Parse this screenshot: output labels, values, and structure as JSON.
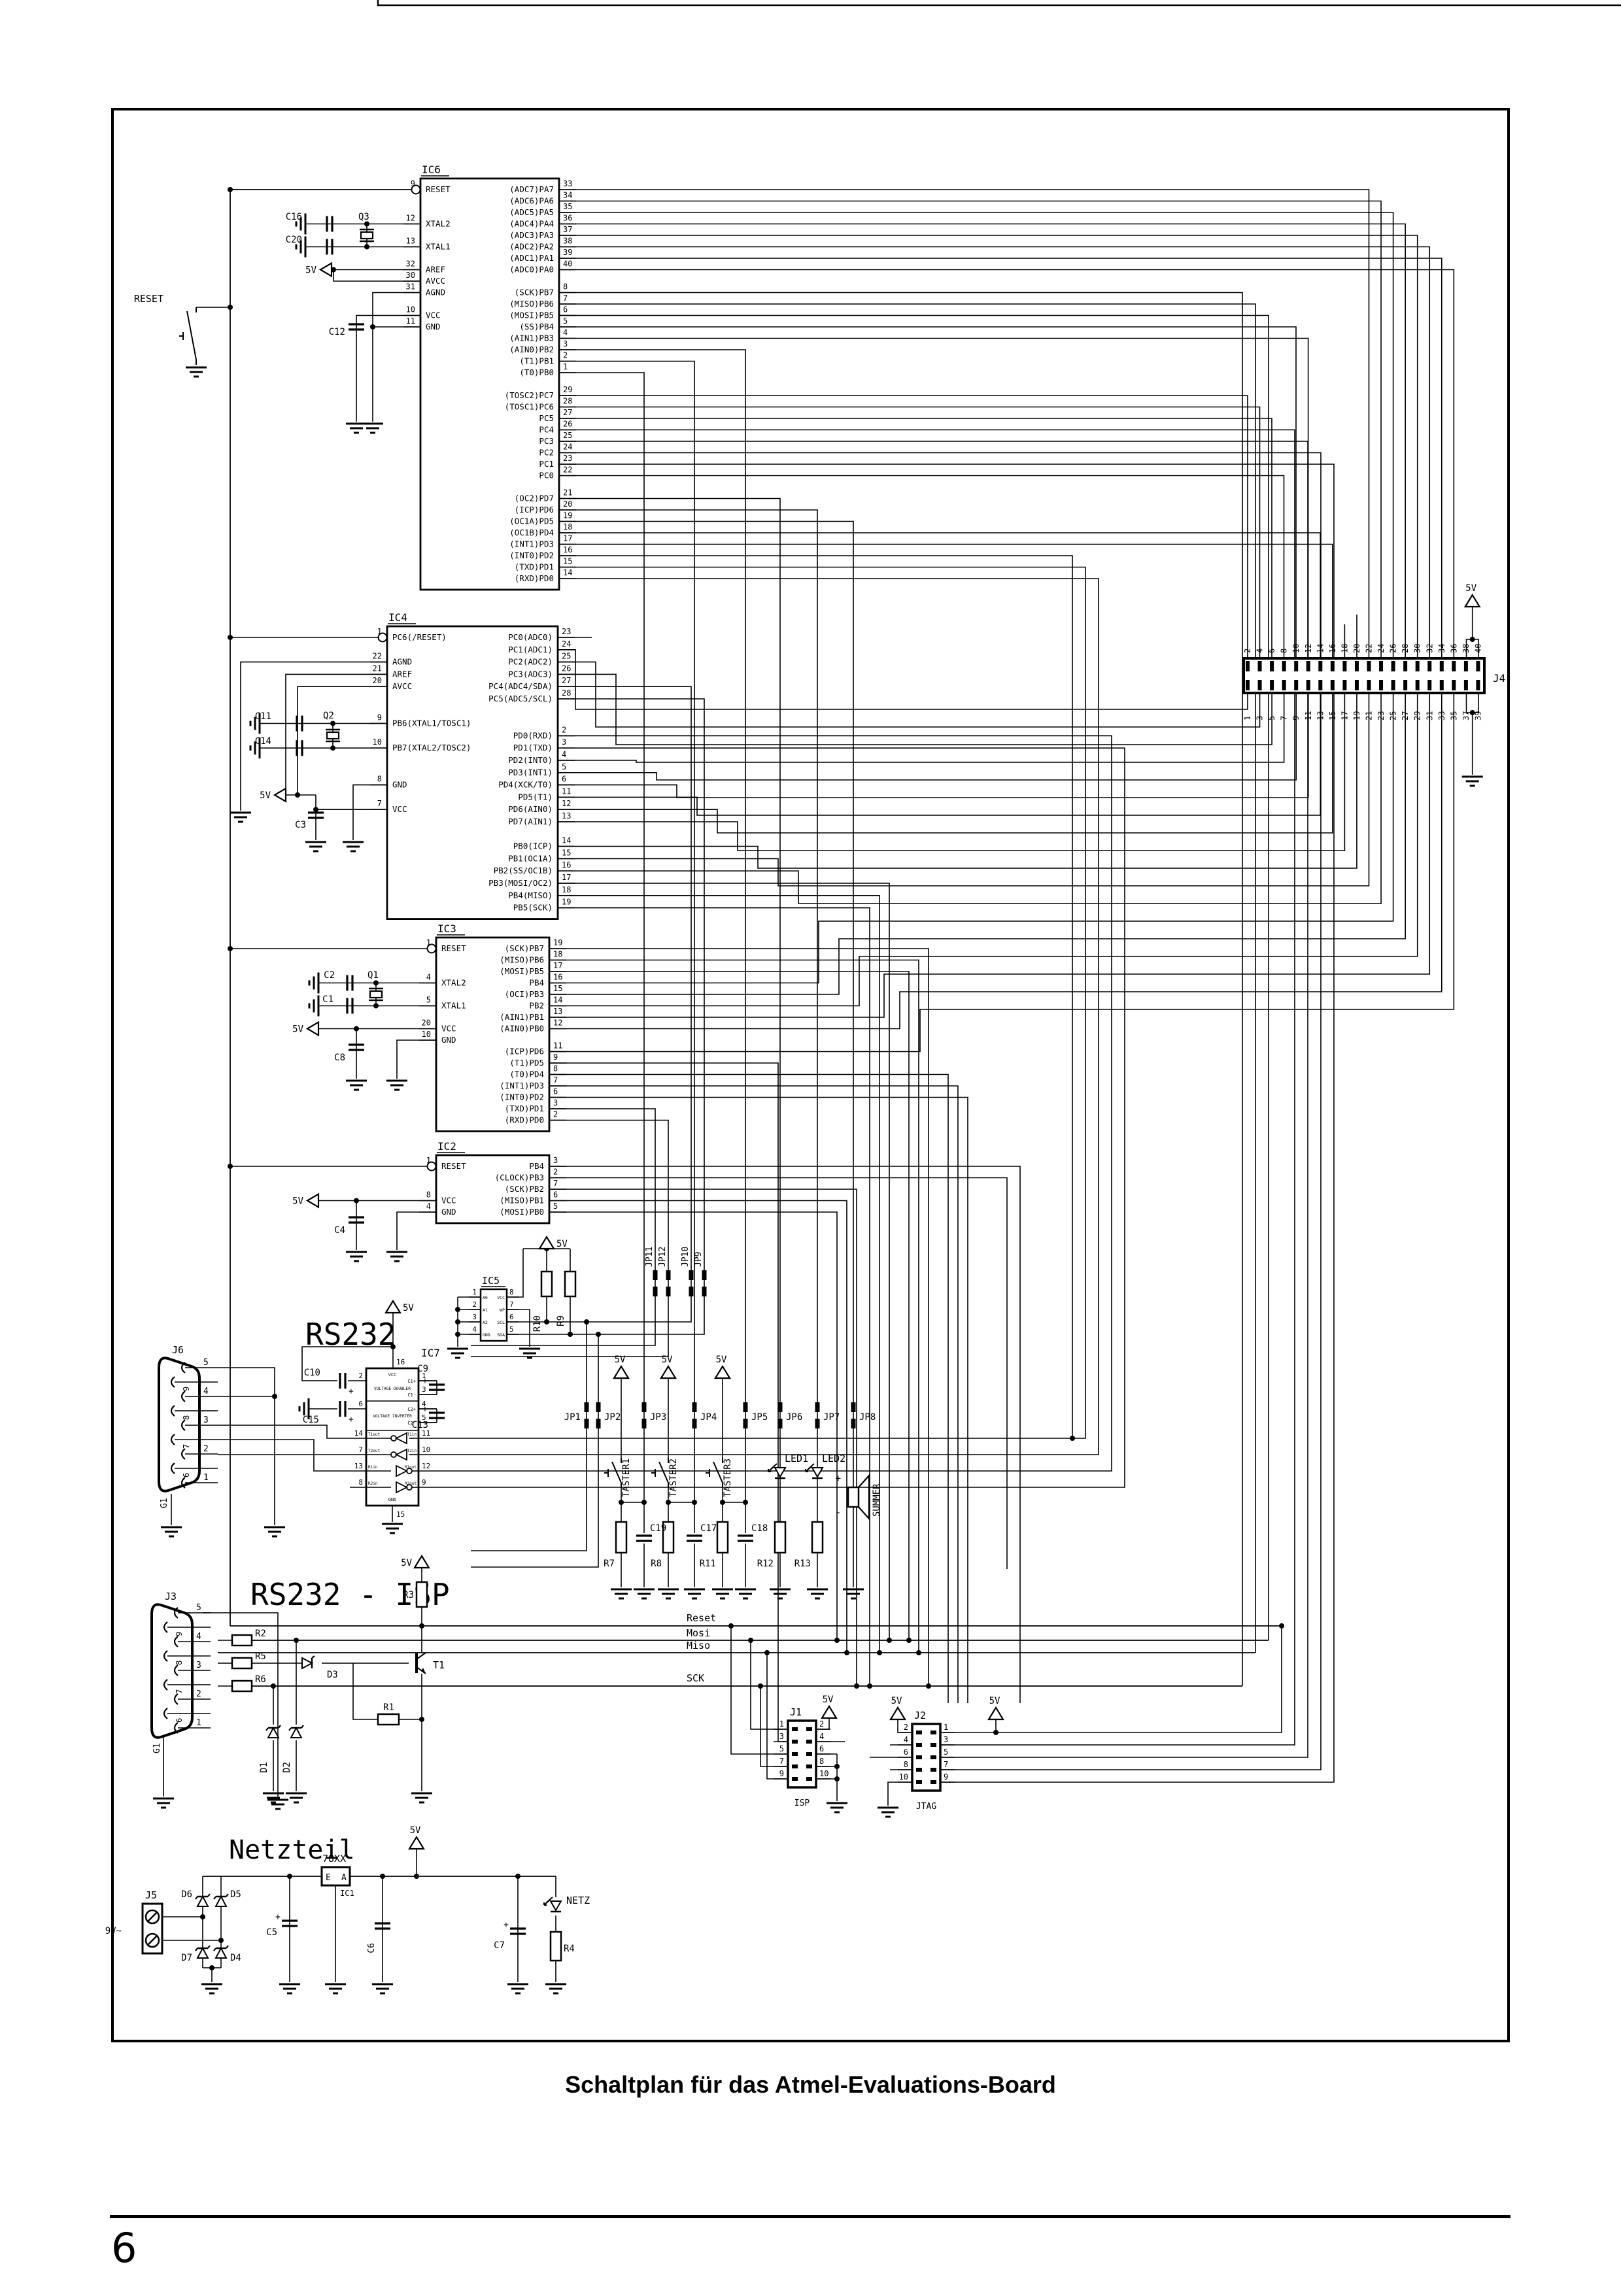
{
  "page": {
    "caption": "Schaltplan für das Atmel-Evaluations-Board",
    "page_number": "6"
  },
  "section_titles": {
    "rs232": "RS232",
    "rs232_isp": "RS232 - ISP",
    "netzteil": "Netzteil"
  },
  "power": {
    "v5": "5V",
    "v9": "9V~"
  },
  "signals": {
    "reset": "Reset",
    "mosi": "Mosi",
    "miso": "Miso",
    "sck": "SCK"
  },
  "ics": {
    "ic6": {
      "title": "IC6",
      "left": [
        [
          "9",
          "RESET",
          1
        ],
        null,
        null,
        [
          "12",
          "XTAL2"
        ],
        null,
        [
          "13",
          "XTAL1"
        ],
        null,
        [
          "32",
          "AREF"
        ],
        [
          "30",
          "AVCC"
        ],
        [
          "31",
          "AGND"
        ],
        null,
        [
          "10",
          "VCC"
        ],
        [
          "11",
          "GND"
        ]
      ],
      "right": [
        [
          "33",
          "(ADC7)PA7"
        ],
        [
          "34",
          "(ADC6)PA6"
        ],
        [
          "35",
          "(ADC5)PA5"
        ],
        [
          "36",
          "(ADC4)PA4"
        ],
        [
          "37",
          "(ADC3)PA3"
        ],
        [
          "38",
          "(ADC2)PA2"
        ],
        [
          "39",
          "(ADC1)PA1"
        ],
        [
          "40",
          "(ADC0)PA0"
        ],
        null,
        [
          "8",
          "(SCK)PB7"
        ],
        [
          "7",
          "(MISO)PB6"
        ],
        [
          "6",
          "(MOSI)PB5"
        ],
        [
          "5",
          "(SS)PB4"
        ],
        [
          "4",
          "(AIN1)PB3"
        ],
        [
          "3",
          "(AIN0)PB2"
        ],
        [
          "2",
          "(T1)PB1"
        ],
        [
          "1",
          "(T0)PB0"
        ],
        null,
        [
          "29",
          "(TOSC2)PC7"
        ],
        [
          "28",
          "(TOSC1)PC6"
        ],
        [
          "27",
          "PC5"
        ],
        [
          "26",
          "PC4"
        ],
        [
          "25",
          "PC3"
        ],
        [
          "24",
          "PC2"
        ],
        [
          "23",
          "PC1"
        ],
        [
          "22",
          "PC0"
        ],
        null,
        [
          "21",
          "(OC2)PD7"
        ],
        [
          "20",
          "(ICP)PD6"
        ],
        [
          "19",
          "(OC1A)PD5"
        ],
        [
          "18",
          "(OC1B)PD4"
        ],
        [
          "17",
          "(INT1)PD3"
        ],
        [
          "16",
          "(INT0)PD2"
        ],
        [
          "15",
          "(TXD)PD1"
        ],
        [
          "14",
          "(RXD)PD0"
        ]
      ]
    },
    "ic4": {
      "title": "IC4",
      "left": [
        [
          "1",
          "PC6(/RESET)",
          1
        ],
        null,
        [
          "22",
          "AGND"
        ],
        [
          "21",
          "AREF"
        ],
        [
          "20",
          "AVCC"
        ],
        null,
        null,
        [
          "9",
          "PB6(XTAL1/TOSC1)"
        ],
        null,
        [
          "10",
          "PB7(XTAL2/TOSC2)"
        ],
        null,
        null,
        [
          "8",
          "GND"
        ],
        null,
        [
          "7",
          "VCC"
        ]
      ],
      "right": [
        [
          "23",
          "PC0(ADC0)"
        ],
        [
          "24",
          "PC1(ADC1)"
        ],
        [
          "25",
          "PC2(ADC2)"
        ],
        [
          "26",
          "PC3(ADC3)"
        ],
        [
          "27",
          "PC4(ADC4/SDA)"
        ],
        [
          "28",
          "PC5(ADC5/SCL)"
        ],
        null,
        null,
        [
          "2",
          "PD0(RXD)"
        ],
        [
          "3",
          "PD1(TXD)"
        ],
        [
          "4",
          "PD2(INT0)"
        ],
        [
          "5",
          "PD3(INT1)"
        ],
        [
          "6",
          "PD4(XCK/T0)"
        ],
        [
          "11",
          "PD5(T1)"
        ],
        [
          "12",
          "PD6(AIN0)"
        ],
        [
          "13",
          "PD7(AIN1)"
        ],
        null,
        [
          "14",
          "PB0(ICP)"
        ],
        [
          "15",
          "PB1(OC1A)"
        ],
        [
          "16",
          "PB2(SS/OC1B)"
        ],
        [
          "17",
          "PB3(MOSI/OC2)"
        ],
        [
          "18",
          "PB4(MISO)"
        ],
        [
          "19",
          "PB5(SCK)"
        ]
      ]
    },
    "ic3": {
      "title": "IC3",
      "left": [
        [
          "1",
          "RESET",
          1
        ],
        null,
        null,
        [
          "4",
          "XTAL2"
        ],
        null,
        [
          "5",
          "XTAL1"
        ],
        null,
        [
          "20",
          "VCC"
        ],
        [
          "10",
          "GND"
        ]
      ],
      "right": [
        [
          "19",
          "(SCK)PB7"
        ],
        [
          "18",
          "(MISO)PB6"
        ],
        [
          "17",
          "(MOSI)PB5"
        ],
        [
          "16",
          "PB4"
        ],
        [
          "15",
          "(OCI)PB3"
        ],
        [
          "14",
          "PB2"
        ],
        [
          "13",
          "(AIN1)PB1"
        ],
        [
          "12",
          "(AIN0)PB0"
        ],
        null,
        [
          "11",
          "(ICP)PD6"
        ],
        [
          "9",
          "(T1)PD5"
        ],
        [
          "8",
          "(T0)PD4"
        ],
        [
          "7",
          "(INT1)PD3"
        ],
        [
          "6",
          "(INT0)PD2"
        ],
        [
          "3",
          "(TXD)PD1"
        ],
        [
          "2",
          "(RXD)PD0"
        ]
      ]
    },
    "ic2": {
      "title": "IC2",
      "left": [
        [
          "1",
          "RESET",
          1
        ],
        null,
        null,
        [
          "8",
          "VCC"
        ],
        [
          "4",
          "GND"
        ]
      ],
      "right": [
        [
          "3",
          "PB4"
        ],
        [
          "2",
          "(CLOCK)PB3"
        ],
        [
          "7",
          "(SCK)PB2"
        ],
        [
          "6",
          "(MISO)PB1"
        ],
        [
          "5",
          "(MOSI)PB0"
        ]
      ]
    },
    "ic5": {
      "title": "IC5",
      "left": [
        [
          "1",
          "A0"
        ],
        [
          "2",
          "A1"
        ],
        [
          "3",
          "A2"
        ],
        [
          "4",
          "GND"
        ]
      ],
      "right": [
        [
          "8",
          "VCC"
        ],
        [
          "7",
          "WP"
        ],
        [
          "6",
          "SCL"
        ],
        [
          "5",
          "SDA"
        ]
      ]
    },
    "ic7": {
      "title": "IC7",
      "vcc": "VCC",
      "gnd": "GND",
      "vcc_num": "16",
      "gnd_num": "15",
      "doubler": "VOLTAGE DOUBLER",
      "inverter": "VOLTAGE INVERTER",
      "in1_num": "2",
      "in2_num": "6",
      "caps": [
        [
          "1",
          "C1+"
        ],
        [
          "3",
          "C1-"
        ],
        [
          "4",
          "C2+"
        ],
        [
          "5",
          "C2-"
        ]
      ],
      "rows": [
        {
          "lnum": "14",
          "lname": "T1out",
          "rname": "T1in",
          "rnum": "11",
          "dir": "left"
        },
        {
          "lnum": "7",
          "lname": "T2out",
          "rname": "T2in",
          "rnum": "10",
          "dir": "left"
        },
        {
          "lnum": "13",
          "lname": "R1in",
          "rname": "R1out",
          "rnum": "12",
          "dir": "right"
        },
        {
          "lnum": "8",
          "lname": "R2in",
          "rname": "R2out",
          "rnum": "9",
          "dir": "right"
        }
      ]
    },
    "ic1": {
      "title": "78XX",
      "e": "E",
      "a": "A",
      "ref": "IC1"
    }
  },
  "connectors": {
    "j6": {
      "name": "J6",
      "gnd": "G1",
      "pins": [
        "5",
        "9",
        "4",
        "8",
        "3",
        "7",
        "2",
        "6",
        "1"
      ]
    },
    "j3": {
      "name": "J3",
      "gnd": "G1",
      "pins": [
        "5",
        "9",
        "4",
        "8",
        "3",
        "7",
        "2",
        "6",
        "1"
      ]
    },
    "j4": {
      "name": "J4",
      "top": [
        "2",
        "4",
        "6",
        "8",
        "10",
        "12",
        "14",
        "16",
        "18",
        "20",
        "22",
        "24",
        "26",
        "28",
        "30",
        "32",
        "34",
        "36",
        "38",
        "40"
      ],
      "bottom": [
        "1",
        "3",
        "5",
        "7",
        "9",
        "11",
        "13",
        "15",
        "17",
        "19",
        "21",
        "23",
        "25",
        "27",
        "29",
        "31",
        "33",
        "35",
        "37",
        "39"
      ]
    },
    "j1": {
      "name": "J1",
      "caption": "ISP",
      "left": [
        "1",
        "3",
        "5",
        "7",
        "9"
      ],
      "right": [
        "2",
        "4",
        "6",
        "8",
        "10"
      ]
    },
    "j2": {
      "name": "J2",
      "caption": "JTAG",
      "left": [
        "2",
        "4",
        "6",
        "8",
        "10"
      ],
      "right": [
        "1",
        "3",
        "5",
        "7",
        "9"
      ]
    },
    "j5": {
      "name": "J5",
      "volts": "9V~"
    }
  },
  "components": {
    "r1": "R1",
    "r2": "R2",
    "r3": "R3",
    "r4": "R4",
    "r5": "R5",
    "r6": "R6",
    "r7": "R7",
    "r8": "R8",
    "r9": "R9",
    "r10": "R10",
    "r11": "R11",
    "r12": "R12",
    "r13": "R13",
    "c1": "C1",
    "c2": "C2",
    "c3": "C3",
    "c4": "C4",
    "c5": "C5",
    "c6": "C6",
    "c7": "C7",
    "c8": "C8",
    "c9": "C9",
    "c10": "C10",
    "c11": "C11",
    "c12": "C12",
    "c13": "C13",
    "c14": "C14",
    "c15": "C15",
    "c16": "C16",
    "c17": "C17",
    "c18": "C18",
    "c19": "C19",
    "c20": "C20",
    "d1": "D1",
    "d2": "D2",
    "d3": "D3",
    "d4": "D4",
    "d5": "D5",
    "d6": "D6",
    "d7": "D7",
    "q1": "Q1",
    "q2": "Q2",
    "q3": "Q3",
    "t1": "T1",
    "led1": "LED1",
    "led2": "LED2",
    "summer": "SUMMER",
    "netz": "NETZ",
    "reset_btn": "RESET",
    "jp1": "JP1",
    "jp2": "JP2",
    "jp3": "JP3",
    "jp4": "JP4",
    "jp5": "JP5",
    "jp6": "JP6",
    "jp7": "JP7",
    "jp8": "JP8",
    "jp9": "JP9",
    "jp10": "JP10",
    "jp11": "JP11",
    "jp12": "JP12",
    "taster1": "TASTER1",
    "taster2": "TASTER2",
    "taster3": "TASTER3"
  }
}
